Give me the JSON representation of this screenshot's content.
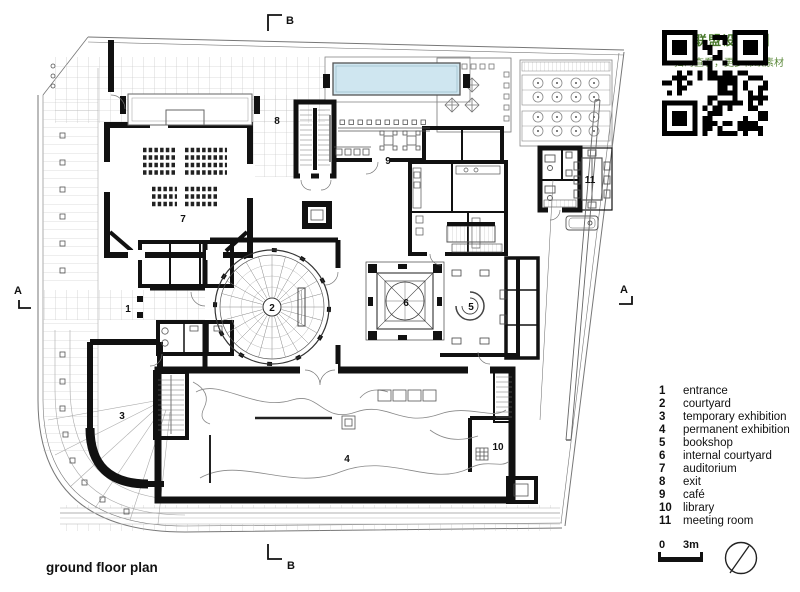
{
  "watermark": {
    "title": "【联盟设计库】",
    "subtitle": "扫码查看，更多稀缺素材"
  },
  "colors": {
    "pool": "#cfe6f0",
    "watermark_green": "#49792c",
    "wall_black": "#111111"
  },
  "plan": {
    "title": "ground floor plan",
    "section_markers": [
      {
        "label": "B",
        "position": "top"
      },
      {
        "label": "B",
        "position": "bottom"
      },
      {
        "label": "A",
        "position": "left"
      },
      {
        "label": "A",
        "position": "right"
      }
    ],
    "labels": [
      {
        "num": "1",
        "name": "entrance",
        "x": 128,
        "y": 312
      },
      {
        "num": "2",
        "name": "courtyard",
        "x": 272,
        "y": 311
      },
      {
        "num": "3",
        "name": "temporary exhibition",
        "x": 122,
        "y": 419
      },
      {
        "num": "4",
        "name": "permanent exhibition",
        "x": 347,
        "y": 462
      },
      {
        "num": "5",
        "name": "bookshop",
        "x": 471,
        "y": 310
      },
      {
        "num": "6",
        "name": "internal courtyard",
        "x": 406,
        "y": 306
      },
      {
        "num": "7",
        "name": "auditorium",
        "x": 183,
        "y": 222
      },
      {
        "num": "8",
        "name": "exit",
        "x": 277,
        "y": 124
      },
      {
        "num": "9",
        "name": "café",
        "x": 388,
        "y": 164
      },
      {
        "num": "10",
        "name": "library",
        "x": 498,
        "y": 450
      },
      {
        "num": "11",
        "name": "meeting room",
        "x": 590,
        "y": 183
      }
    ]
  },
  "legend": {
    "items": [
      {
        "num": "1",
        "label": "entrance"
      },
      {
        "num": "2",
        "label": "courtyard"
      },
      {
        "num": "3",
        "label": "temporary exhibition"
      },
      {
        "num": "4",
        "label": "permanent exhibition"
      },
      {
        "num": "5",
        "label": "bookshop"
      },
      {
        "num": "6",
        "label": "internal courtyard"
      },
      {
        "num": "7",
        "label": "auditorium"
      },
      {
        "num": "8",
        "label": "exit"
      },
      {
        "num": "9",
        "label": "café"
      },
      {
        "num": "10",
        "label": "library"
      },
      {
        "num": "11",
        "label": "meeting room"
      }
    ]
  },
  "scale_bar": {
    "zero": "0",
    "three_m": "3m"
  }
}
